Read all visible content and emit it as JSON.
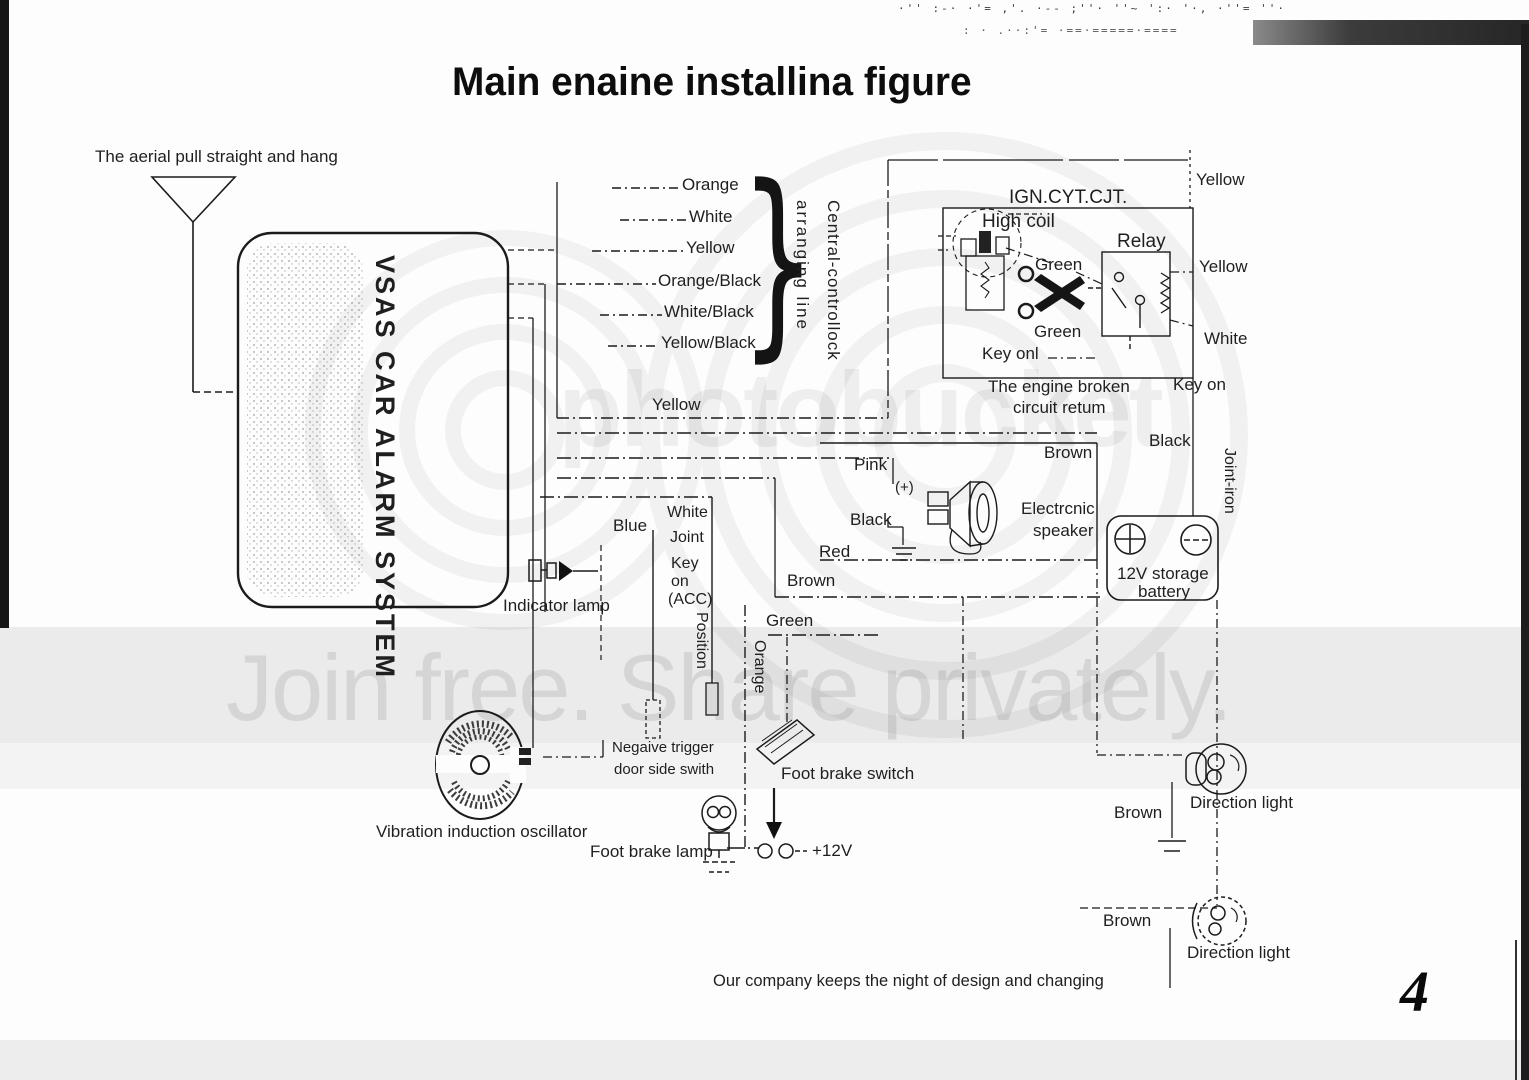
{
  "header": {
    "title": "Main enaine installina figure",
    "noise_row_1": "·'' :-· ·'= ,'. ·-- ;''· ''~ ':· '·, ·''= ''·",
    "noise_row_2": ": · .··:'= ·==·=====·===="
  },
  "watermark": {
    "brand": "photobucket",
    "tagline": "Join free. Share privately."
  },
  "page": {
    "number": "4",
    "footer": "Our company keeps the night of design and changing"
  },
  "aerial": {
    "label": "The aerial pull straight and hang"
  },
  "unit": {
    "label": "VSAS CAR ALARM SYSTEM"
  },
  "harness": {
    "wire_1": "Orange",
    "wire_2": "White",
    "wire_3": "Yellow",
    "wire_4": "Orange/Black",
    "wire_5": "White/Black",
    "wire_6": "Yellow/Black",
    "brace": "}",
    "group_label_line": "arranging line",
    "group_label_main": "Central-controllock"
  },
  "ign": {
    "title": "IGN.CYT.CJT.",
    "high_coil": "High coil",
    "relay": "Relay",
    "green_top": "Green",
    "green_bottom": "Green",
    "key_on": "Key onl",
    "caption_1": "The engine broken",
    "caption_2": "circuit retum",
    "yellow_top": "Yellow",
    "yellow_side": "Yellow",
    "white_side": "White",
    "key_on_side": "Key on"
  },
  "mid": {
    "yellow_bus": "Yellow",
    "pink": "Pink",
    "plus": "(+)",
    "black": "Black",
    "red": "Red",
    "brown": "Brown",
    "speaker_1": "Electrcnic",
    "speaker_2": "speaker",
    "black_down": "Black",
    "joint_iron": "Joint-iron",
    "battery_1": "12V storage",
    "battery_2": "battery",
    "blue": "Blue",
    "white": "White",
    "joint": "Joint",
    "key": "Key",
    "on": "on",
    "acc": "(ACC)",
    "position": "Position",
    "orange": "Orange",
    "brown_2": "Brown",
    "green_2": "Green",
    "indicator": "Indicator lamp"
  },
  "bottom": {
    "vibration": "Vibration induction oscillator",
    "neg_1": "Negaive trigger",
    "neg_2": "door side swith",
    "foot_switch": "Foot brake switch",
    "foot_lamp": "Foot brake lamp",
    "v12": "+12V",
    "brown_dir_1": "Brown",
    "dir_light_1": "Direction light",
    "brown_dir_2": "Brown",
    "dir_light_2": "Direction light"
  }
}
